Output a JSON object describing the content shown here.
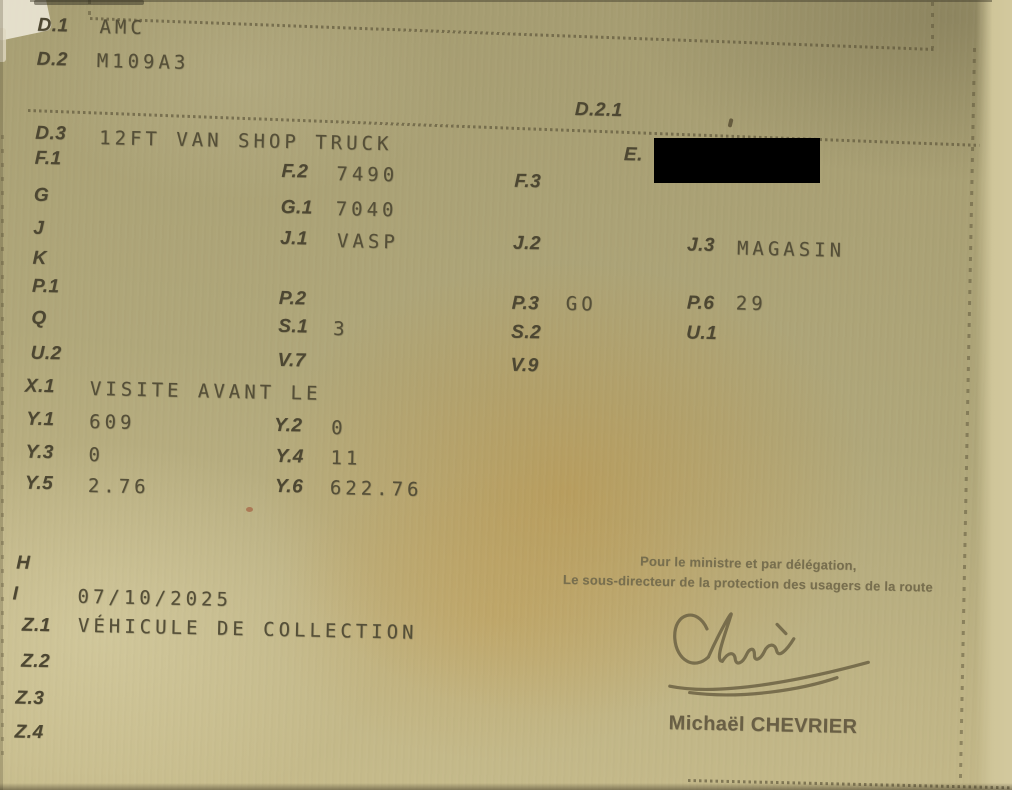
{
  "colors": {
    "paper": "#aba275",
    "ink_label": "#4d4732",
    "ink_value": "#554f38",
    "redaction": "#000000",
    "signature_ink": "#6f6546"
  },
  "fields": {
    "d1": {
      "label": "D.1",
      "value": "AMC"
    },
    "d2": {
      "label": "D.2",
      "value": "M109A3"
    },
    "d21": {
      "label": "D.2.1",
      "value": ""
    },
    "d3": {
      "label": "D.3",
      "value": "12FT VAN SHOP TRUCK"
    },
    "e": {
      "label": "E.",
      "value": "",
      "redacted": true
    },
    "f1": {
      "label": "F.1",
      "value": ""
    },
    "f2": {
      "label": "F.2",
      "value": "7490"
    },
    "f3": {
      "label": "F.3",
      "value": ""
    },
    "g": {
      "label": "G",
      "value": ""
    },
    "g1": {
      "label": "G.1",
      "value": "7040"
    },
    "j": {
      "label": "J",
      "value": ""
    },
    "j1": {
      "label": "J.1",
      "value": "VASP"
    },
    "j2": {
      "label": "J.2",
      "value": ""
    },
    "j3": {
      "label": "J.3",
      "value": "MAGASIN"
    },
    "k": {
      "label": "K",
      "value": ""
    },
    "p1": {
      "label": "P.1",
      "value": ""
    },
    "p2": {
      "label": "P.2",
      "value": ""
    },
    "p3": {
      "label": "P.3",
      "value": "GO"
    },
    "p6": {
      "label": "P.6",
      "value": "29"
    },
    "q": {
      "label": "Q",
      "value": ""
    },
    "s1": {
      "label": "S.1",
      "value": "3"
    },
    "s2": {
      "label": "S.2",
      "value": ""
    },
    "u1": {
      "label": "U.1",
      "value": ""
    },
    "u2": {
      "label": "U.2",
      "value": ""
    },
    "v7": {
      "label": "V.7",
      "value": ""
    },
    "v9": {
      "label": "V.9",
      "value": ""
    },
    "x1": {
      "label": "X.1",
      "value": "VISITE AVANT LE"
    },
    "y1": {
      "label": "Y.1",
      "value": "609"
    },
    "y2": {
      "label": "Y.2",
      "value": "0"
    },
    "y3": {
      "label": "Y.3",
      "value": "0"
    },
    "y4": {
      "label": "Y.4",
      "value": "11"
    },
    "y5": {
      "label": "Y.5",
      "value": "2.76"
    },
    "y6": {
      "label": "Y.6",
      "value": "622.76"
    },
    "h": {
      "label": "H",
      "value": ""
    },
    "i": {
      "label": "I",
      "value": "07/10/2025"
    },
    "z1": {
      "label": "Z.1",
      "value": "VÉHICULE DE COLLECTION"
    },
    "z2": {
      "label": "Z.2",
      "value": ""
    },
    "z3": {
      "label": "Z.3",
      "value": ""
    },
    "z4": {
      "label": "Z.4",
      "value": ""
    }
  },
  "signature": {
    "delegation_line1": "Pour le ministre et par délégation,",
    "delegation_line2": "Le sous-directeur de la protection des usagers de la route",
    "signer_name": "Michaël CHEVRIER"
  }
}
